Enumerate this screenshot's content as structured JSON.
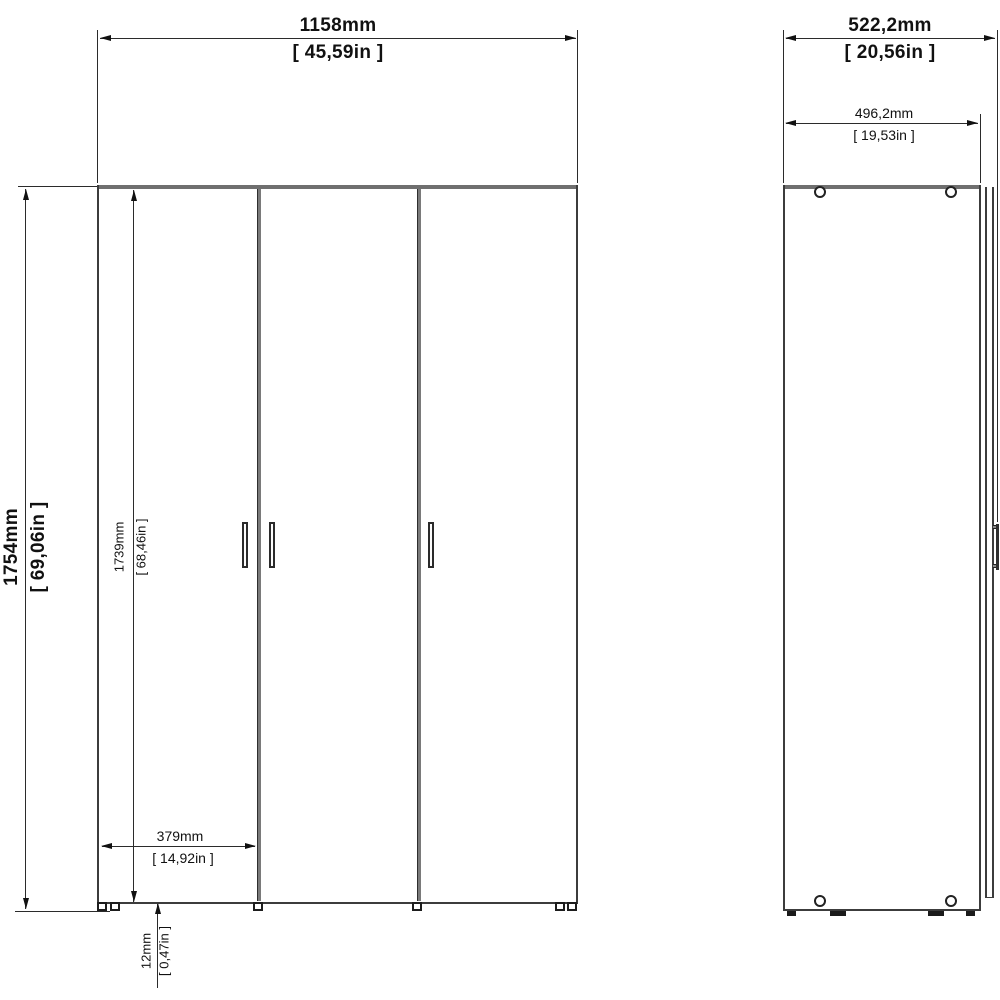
{
  "drawing": {
    "type": "furniture-technical-drawing",
    "views": {
      "front": {
        "label": "front-view",
        "doors": 3,
        "handles": 3
      },
      "side": {
        "label": "side-view",
        "cam_holes": 4
      }
    },
    "colors": {
      "background": "#ffffff",
      "line": "#2b2b2b",
      "panel_edge": "#6f6f6f",
      "text": "#111111"
    },
    "dims": {
      "front_width": {
        "mm": "1158mm",
        "in": "[ 45,59in ]"
      },
      "front_height": {
        "mm": "1754mm",
        "in": "[ 69,06in ]"
      },
      "door_height": {
        "mm": "1739mm",
        "in": "[ 68,46in ]"
      },
      "door_width": {
        "mm": "379mm",
        "in": "[ 14,92in ]"
      },
      "bottom_gap": {
        "mm": "12mm",
        "in": "[ 0,47in ]"
      },
      "depth_total": {
        "mm": "522,2mm",
        "in": "[ 20,56in ]"
      },
      "depth_carcass": {
        "mm": "496,2mm",
        "in": "[ 19,53in ]"
      }
    }
  }
}
